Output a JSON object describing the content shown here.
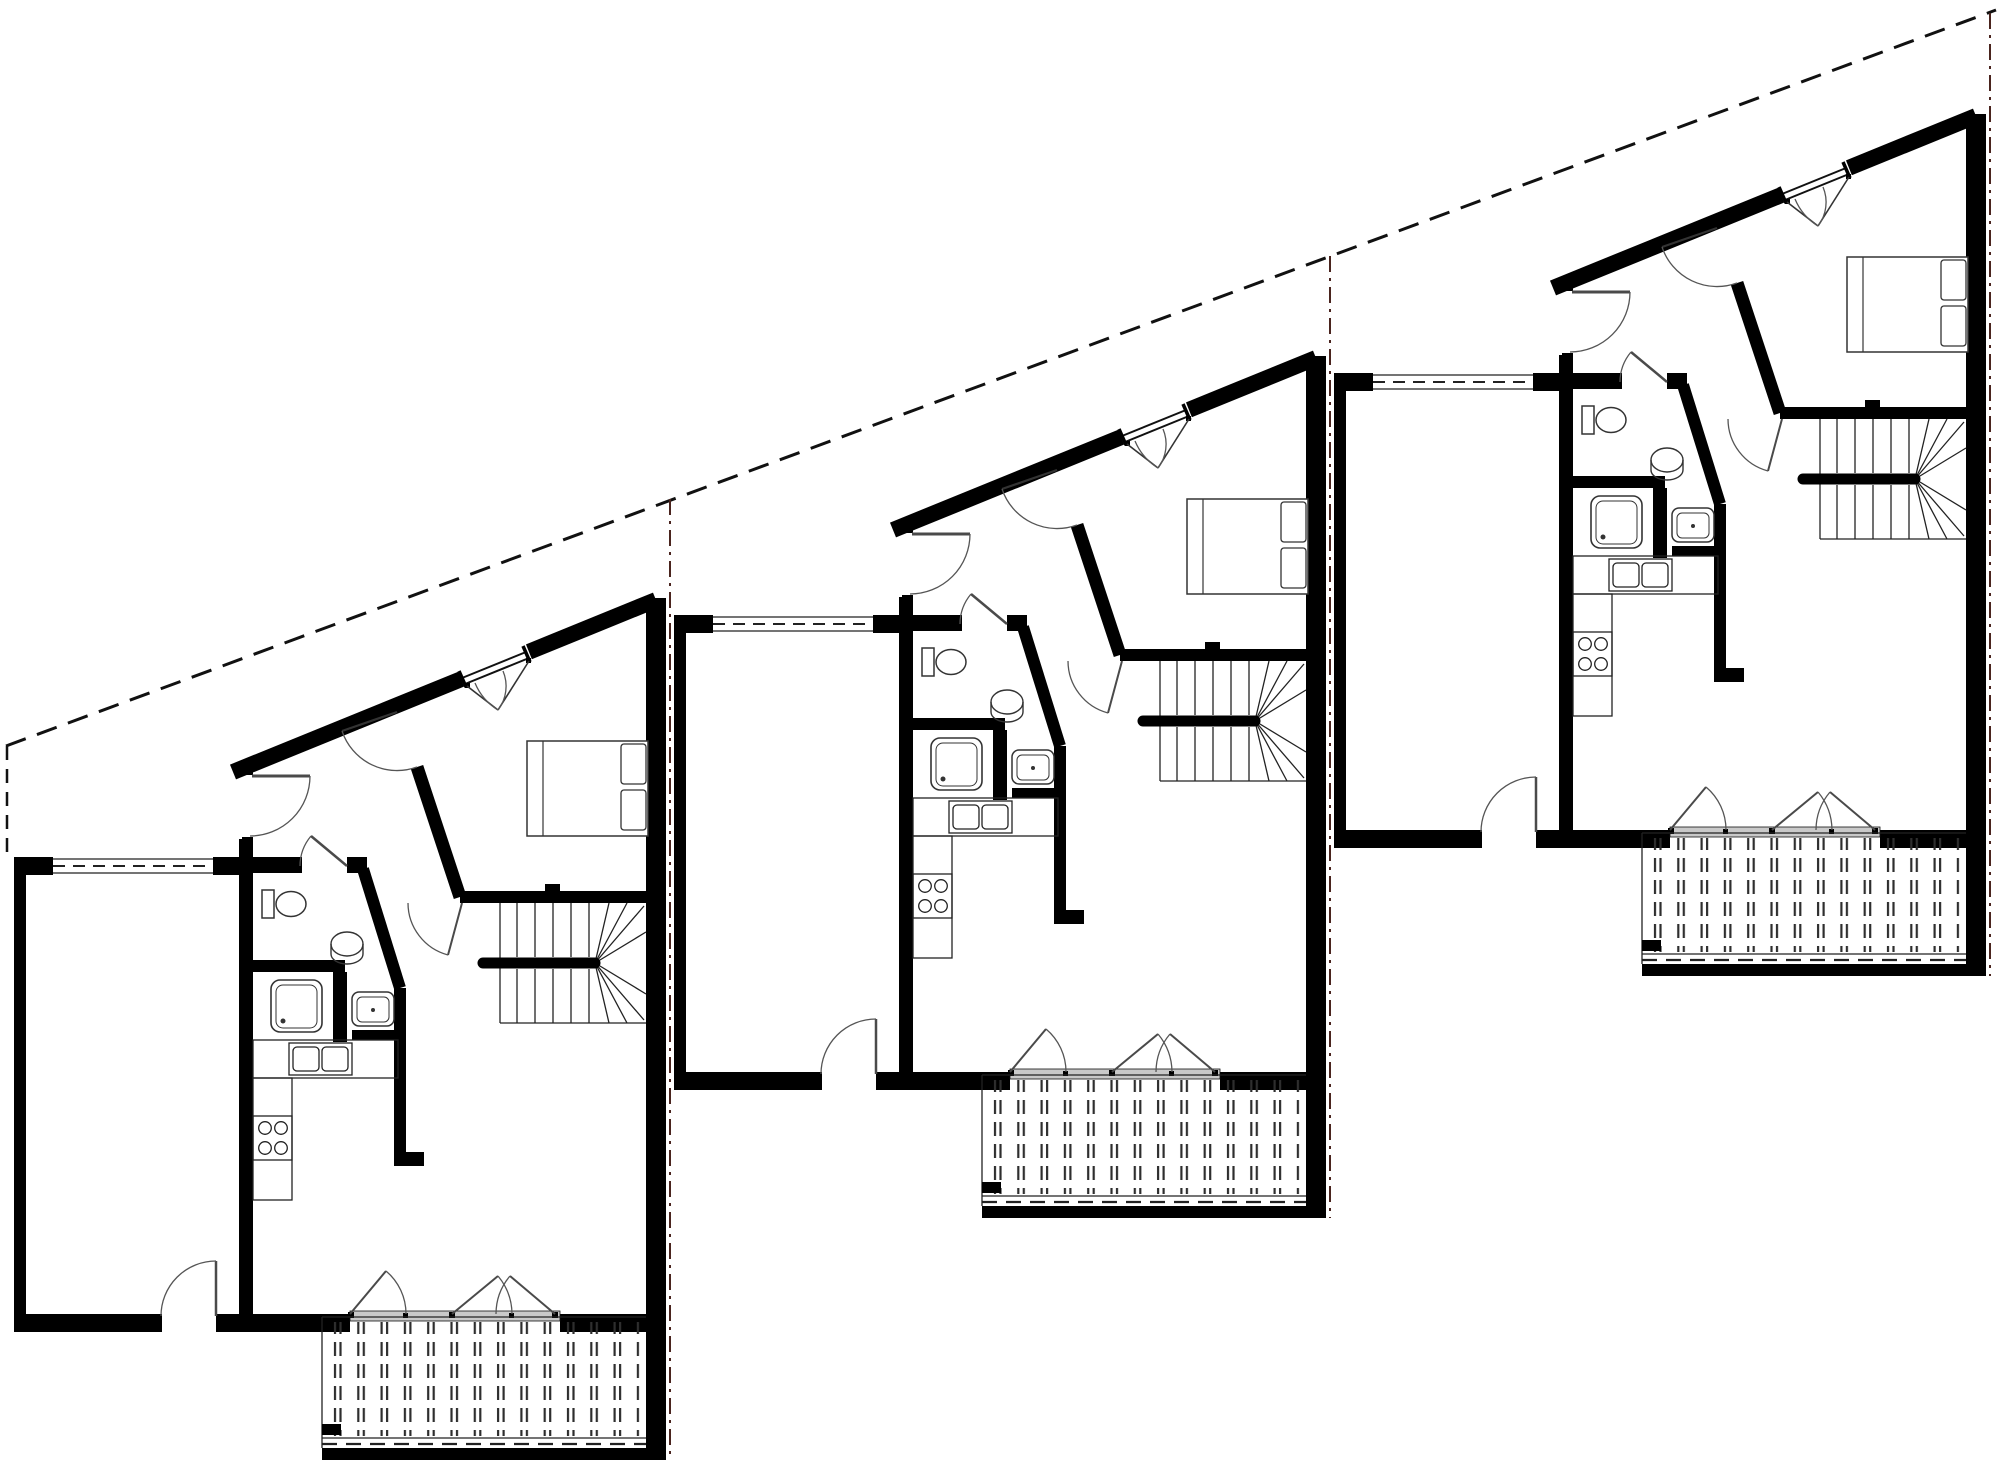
{
  "scene": {
    "type": "architectural-floor-plan",
    "background": "#ffffff",
    "width": 2000,
    "height": 1460,
    "visible_text": "none"
  },
  "colors": {
    "walls": "#000000",
    "thin_lines": "#222222",
    "fixtures": "#333333",
    "door_leaves": "#4a4a4a",
    "swing_arcs": "#555555",
    "site_boundary": "#111111",
    "party_line": "#4a241e",
    "door_sill": "#c9c9c9",
    "background": "#ffffff"
  },
  "site": {
    "boundary_diagonal": {
      "x1": 6,
      "y1": 746,
      "x2": 1996,
      "y2": 10,
      "dash": "21 12",
      "width": 3
    },
    "boundary_left_vertical": {
      "x1": 7,
      "y1": 746,
      "x2": 7,
      "y2": 860,
      "dash": "14 9",
      "width": 2.5
    },
    "party_lines": [
      {
        "x": 670,
        "y1": 499,
        "y2": 1460
      },
      {
        "x": 1330,
        "y1": 256,
        "y2": 1218
      },
      {
        "x": 1990,
        "y1": 13,
        "y2": 976
      }
    ],
    "party_dash": "16 6 3 6"
  },
  "units": [
    {
      "id": "unit-1",
      "dx": 0,
      "dy": 0
    },
    {
      "id": "unit-2",
      "dx": 660,
      "dy": -242
    },
    {
      "id": "unit-3",
      "dx": 1320,
      "dy": -484
    }
  ],
  "unit_contents": {
    "rooms": [
      "garage",
      "entry-hall",
      "bathroom",
      "shower-niche",
      "kitchen",
      "living-room",
      "bedroom",
      "deck"
    ],
    "fixtures": {
      "bed_pillows": 2,
      "stove_burners": 4,
      "kitchen_sink_bowls": 2,
      "bathroom": [
        "toilet",
        "cylinder-boiler",
        "shower-tray",
        "wash-basin"
      ],
      "stair_straight_treads_per_run": 5,
      "stair_winder_lines_per_side": 4,
      "deck_slat_columns": 14,
      "deck_door_leaves": 3,
      "windows_on_sloped_wall": 1
    },
    "doors": [
      "entry-door",
      "garage-door",
      "bathroom-door",
      "bedroom-door",
      "hall-living-door",
      "deck-french-doors"
    ]
  }
}
